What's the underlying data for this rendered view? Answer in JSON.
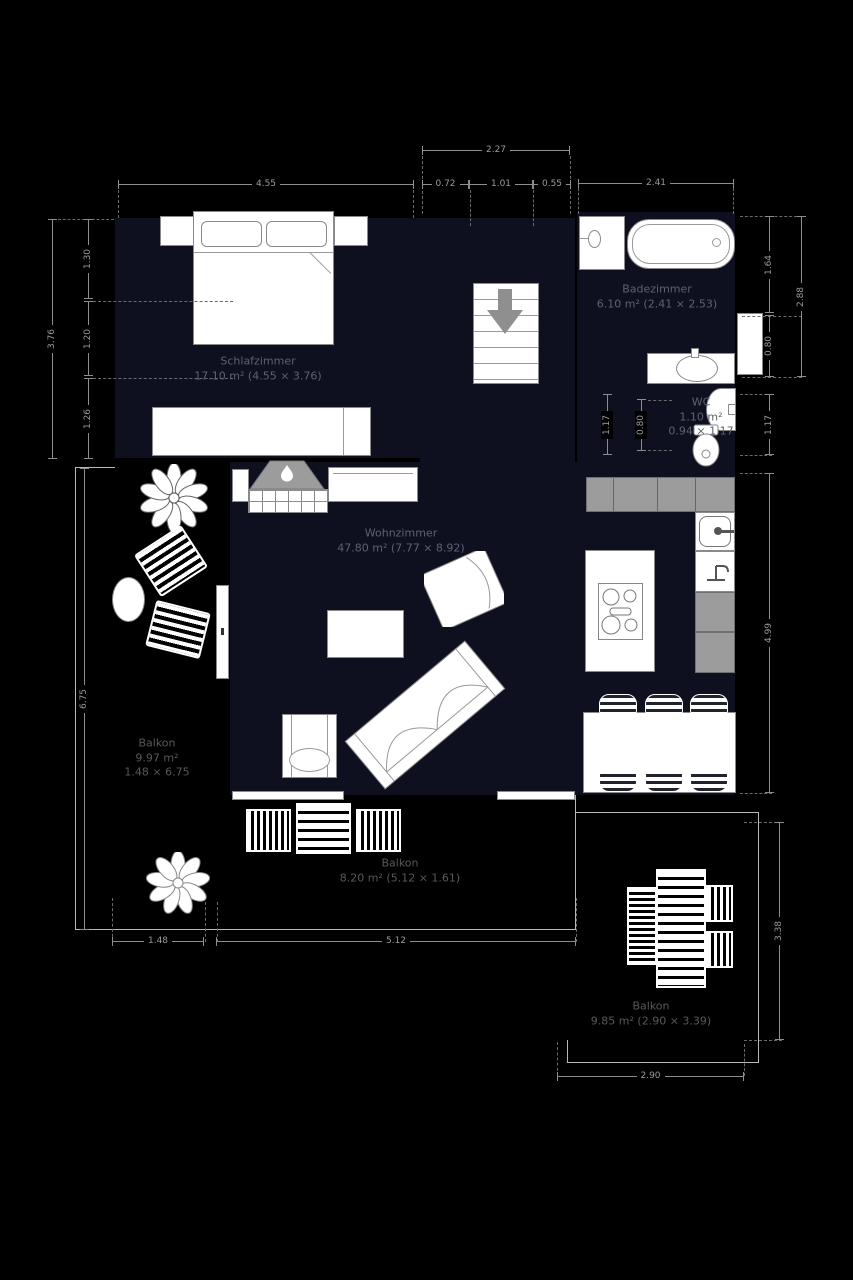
{
  "rooms": {
    "schlafzimmer": {
      "name": "Schlafzimmer",
      "details": "17.10 m² (4.55 × 3.76)"
    },
    "badezimmer": {
      "name": "Badezimmer",
      "details": "6.10 m² (2.41 × 2.53)"
    },
    "wc": {
      "name": "WC",
      "area": "1.10 m²",
      "size": "0.94 × 1.17"
    },
    "wohnzimmer": {
      "name": "Wohnzimmer",
      "details": "47.80 m² (7.77 × 8.92)"
    },
    "balkon_links": {
      "name": "Balkon",
      "area": "9.97 m²",
      "size": "1.48 × 6.75"
    },
    "balkon_unten": {
      "name": "Balkon",
      "details": "8.20 m² (5.12 × 1.61)"
    },
    "balkon_rechts": {
      "name": "Balkon",
      "details": "9.85 m² (2.90 × 3.39)"
    }
  },
  "dimensions": [
    {
      "value": "2.27",
      "orient": "h",
      "x": 422,
      "y": 150,
      "len": 148
    },
    {
      "value": "4.55",
      "orient": "h",
      "x": 118,
      "y": 184,
      "len": 296
    },
    {
      "value": "0.72",
      "orient": "h",
      "x": 422,
      "y": 184,
      "len": 47
    },
    {
      "value": "1.01",
      "orient": "h",
      "x": 469,
      "y": 184,
      "len": 64
    },
    {
      "value": "0.55",
      "orient": "h",
      "x": 533,
      "y": 184,
      "len": 38
    },
    {
      "value": "2.41",
      "orient": "h",
      "x": 578,
      "y": 183,
      "len": 156
    },
    {
      "value": "1.48",
      "orient": "h",
      "x": 112,
      "y": 941,
      "len": 92
    },
    {
      "value": "5.12",
      "orient": "h",
      "x": 216,
      "y": 941,
      "len": 360
    },
    {
      "value": "2.90",
      "orient": "h",
      "x": 557,
      "y": 1076,
      "len": 187
    },
    {
      "value": "3.76",
      "orient": "v",
      "x": 52,
      "y": 219,
      "len": 240
    },
    {
      "value": "1.30",
      "orient": "v",
      "x": 88,
      "y": 219,
      "len": 80
    },
    {
      "value": "1.20",
      "orient": "v",
      "x": 88,
      "y": 301,
      "len": 75
    },
    {
      "value": "1.26",
      "orient": "v",
      "x": 88,
      "y": 378,
      "len": 81
    },
    {
      "value": "1.64",
      "orient": "v",
      "x": 769,
      "y": 216,
      "len": 97
    },
    {
      "value": "0.80",
      "orient": "v",
      "x": 769,
      "y": 315,
      "len": 62
    },
    {
      "value": "2.88",
      "orient": "v",
      "x": 801,
      "y": 216,
      "len": 161
    },
    {
      "value": "1.17",
      "orient": "v",
      "x": 607,
      "y": 394,
      "len": 61
    },
    {
      "value": "0.80",
      "orient": "v",
      "x": 641,
      "y": 399,
      "len": 52
    },
    {
      "value": "1.17",
      "orient": "v",
      "x": 769,
      "y": 394,
      "len": 61
    },
    {
      "value": "4.99",
      "orient": "v",
      "x": 769,
      "y": 473,
      "len": 320
    },
    {
      "value": "6.75",
      "orient": "v",
      "x": 84,
      "y": 468,
      "len": 462
    },
    {
      "value": "3.38",
      "orient": "v",
      "x": 779,
      "y": 822,
      "len": 218
    }
  ],
  "guides": [
    {
      "orient": "v",
      "x": 118,
      "y": 190,
      "len": 28
    },
    {
      "orient": "v",
      "x": 413,
      "y": 190,
      "len": 28
    },
    {
      "orient": "v",
      "x": 422,
      "y": 156,
      "len": 58
    },
    {
      "orient": "v",
      "x": 470,
      "y": 190,
      "len": 36
    },
    {
      "orient": "v",
      "x": 533,
      "y": 190,
      "len": 36
    },
    {
      "orient": "v",
      "x": 570,
      "y": 156,
      "len": 58
    },
    {
      "orient": "v",
      "x": 578,
      "y": 188,
      "len": 26
    },
    {
      "orient": "v",
      "x": 733,
      "y": 188,
      "len": 26
    },
    {
      "orient": "v",
      "x": 112,
      "y": 898,
      "len": 44
    },
    {
      "orient": "v",
      "x": 205,
      "y": 902,
      "len": 40
    },
    {
      "orient": "v",
      "x": 217,
      "y": 902,
      "len": 40
    },
    {
      "orient": "v",
      "x": 576,
      "y": 898,
      "len": 44
    },
    {
      "orient": "v",
      "x": 557,
      "y": 1042,
      "len": 34
    },
    {
      "orient": "v",
      "x": 744,
      "y": 1044,
      "len": 32
    },
    {
      "orient": "h",
      "x": 58,
      "y": 219,
      "len": 56
    },
    {
      "orient": "h",
      "x": 93,
      "y": 301,
      "len": 140
    },
    {
      "orient": "h",
      "x": 93,
      "y": 378,
      "len": 140
    },
    {
      "orient": "h",
      "x": 740,
      "y": 216,
      "len": 62
    },
    {
      "orient": "h",
      "x": 742,
      "y": 316,
      "len": 60
    },
    {
      "orient": "h",
      "x": 742,
      "y": 377,
      "len": 60
    },
    {
      "orient": "h",
      "x": 740,
      "y": 394,
      "len": 32
    },
    {
      "orient": "h",
      "x": 740,
      "y": 455,
      "len": 32
    },
    {
      "orient": "h",
      "x": 740,
      "y": 473,
      "len": 32
    },
    {
      "orient": "h",
      "x": 740,
      "y": 793,
      "len": 32
    },
    {
      "orient": "h",
      "x": 648,
      "y": 400,
      "len": 24
    },
    {
      "orient": "h",
      "x": 648,
      "y": 450,
      "len": 24
    },
    {
      "orient": "h",
      "x": 744,
      "y": 822,
      "len": 38
    },
    {
      "orient": "h",
      "x": 744,
      "y": 1040,
      "len": 38
    }
  ],
  "colors": {
    "background": "#000000",
    "room_floor": "#0e101f",
    "furniture_fill": "#ffffff",
    "outline": "#8a8a8a",
    "counter_gray": "#9c9c9c",
    "dimension_text": "#9a9a9a",
    "room_label_text": "#5c6270",
    "balcony_label_text": "#585858"
  },
  "icons": {
    "stairs_direction": "down-arrow",
    "fireplace": "flame",
    "plants": "flower",
    "toilet": "toilet-top-view",
    "bathtub": "bathtub-top-view",
    "cooktop": "4-burner-stove",
    "sink": "sink-basin"
  }
}
